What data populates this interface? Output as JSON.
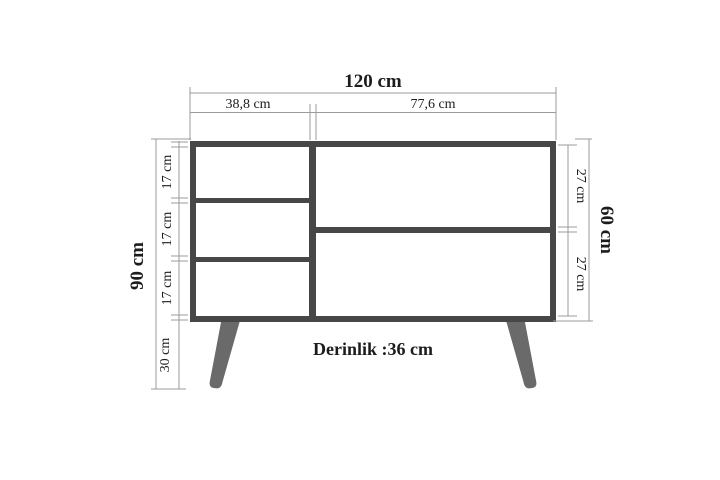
{
  "figure": {
    "kind": "furniture-dimension-diagram",
    "width_total": "120 cm",
    "width_left_section": "38,8 cm",
    "width_right_section": "77,6 cm",
    "height_total": "90 cm",
    "height_body": "60 cm",
    "left_compartments": [
      "17 cm",
      "17 cm",
      "17 cm"
    ],
    "leg_height": "30 cm",
    "right_compartments": [
      "27 cm",
      "27 cm"
    ],
    "depth_note": "Derinlik :36 cm"
  },
  "colors": {
    "body_stroke": "#474747",
    "leg_fill": "#6a6a6a",
    "dimension_line": "#9b9b9b",
    "text": "#1c1c1c",
    "background": "#ffffff"
  }
}
